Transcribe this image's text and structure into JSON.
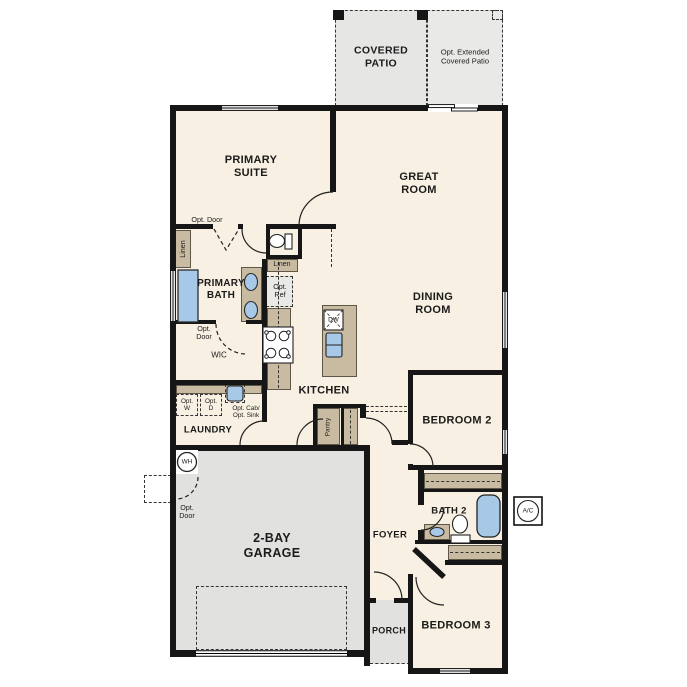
{
  "rooms": {
    "covered_patio": "COVERED\nPATIO",
    "opt_extended_patio": "Opt. Extended\nCovered Patio",
    "primary_suite": "PRIMARY\nSUITE",
    "great_room": "GREAT\nROOM",
    "dining_room": "DINING\nROOM",
    "primary_bath": "PRIMARY\nBATH",
    "wic": "WIC",
    "kitchen": "KITCHEN",
    "laundry": "LAUNDRY",
    "bedroom2": "BEDROOM 2",
    "garage": "2-BAY\nGARAGE",
    "foyer": "FOYER",
    "bath2": "BATH 2",
    "bedroom3": "BEDROOM 3",
    "porch": "PORCH"
  },
  "features": {
    "opt_door": "Opt. Door",
    "opt_door_two_line": "Opt.\nDoor",
    "linen": "Linen",
    "opt_ref": "Opt.\nRef",
    "dw": "DW",
    "pantry": "Pantry",
    "opt_w": "Opt.\nW",
    "opt_d": "Opt.\nD",
    "opt_cab_sink": "Opt. Cab/\nOpt. Sink",
    "wh": "WH",
    "ac": "A/C"
  },
  "colors": {
    "floor": "#f8f0e2",
    "garage": "#e1e1e0",
    "patio": "#e6e6e4",
    "cabinet": "#c9bba1",
    "fixture": "#a8c8e8",
    "wall": "#161616"
  }
}
